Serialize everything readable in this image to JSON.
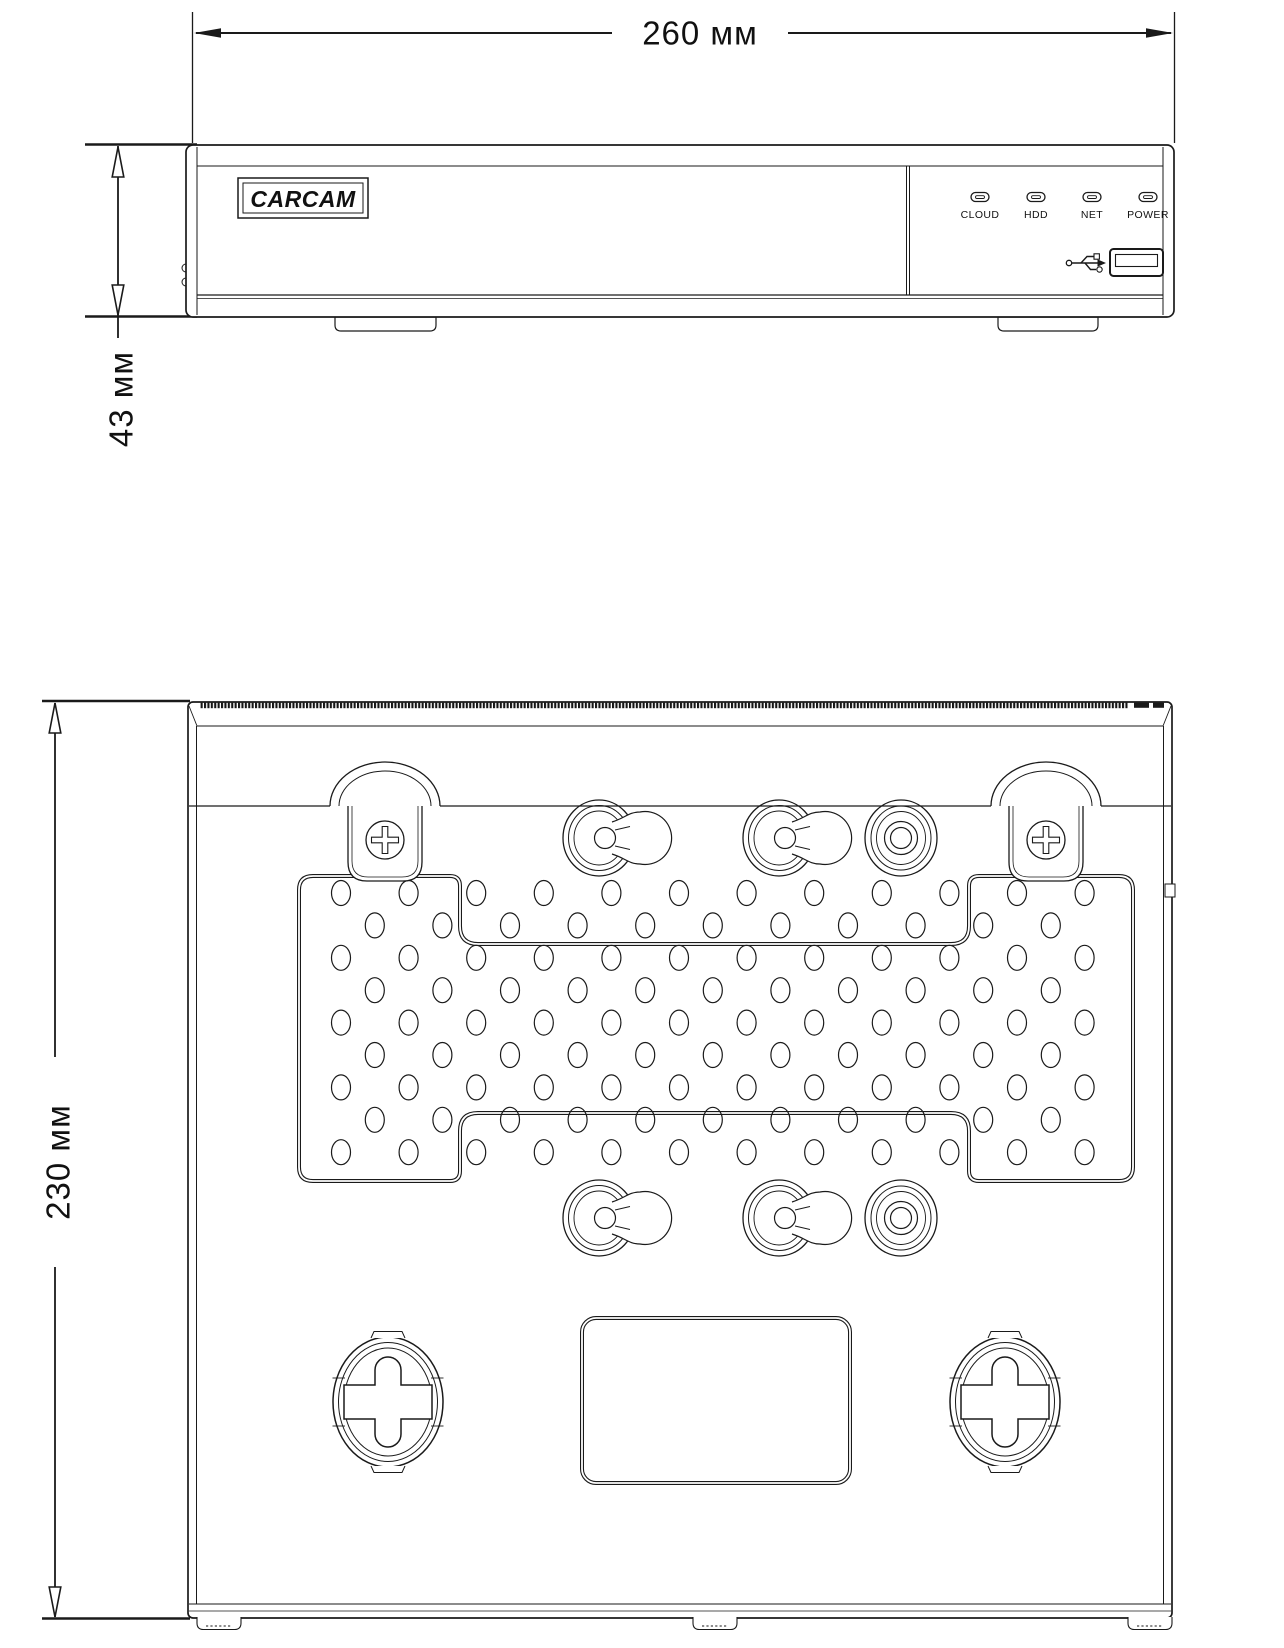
{
  "colors": {
    "line": "#1a1a1a",
    "background": "#ffffff"
  },
  "dimensions": {
    "width_label": "260 мм",
    "height_label": "43 мм",
    "depth_label": "230 мм"
  },
  "front_panel": {
    "brand": "CARCAM",
    "leds": [
      {
        "label": "CLOUD"
      },
      {
        "label": "HDD"
      },
      {
        "label": "NET"
      },
      {
        "label": "POWER"
      }
    ],
    "icons": {
      "usb": "usb-trident"
    }
  }
}
